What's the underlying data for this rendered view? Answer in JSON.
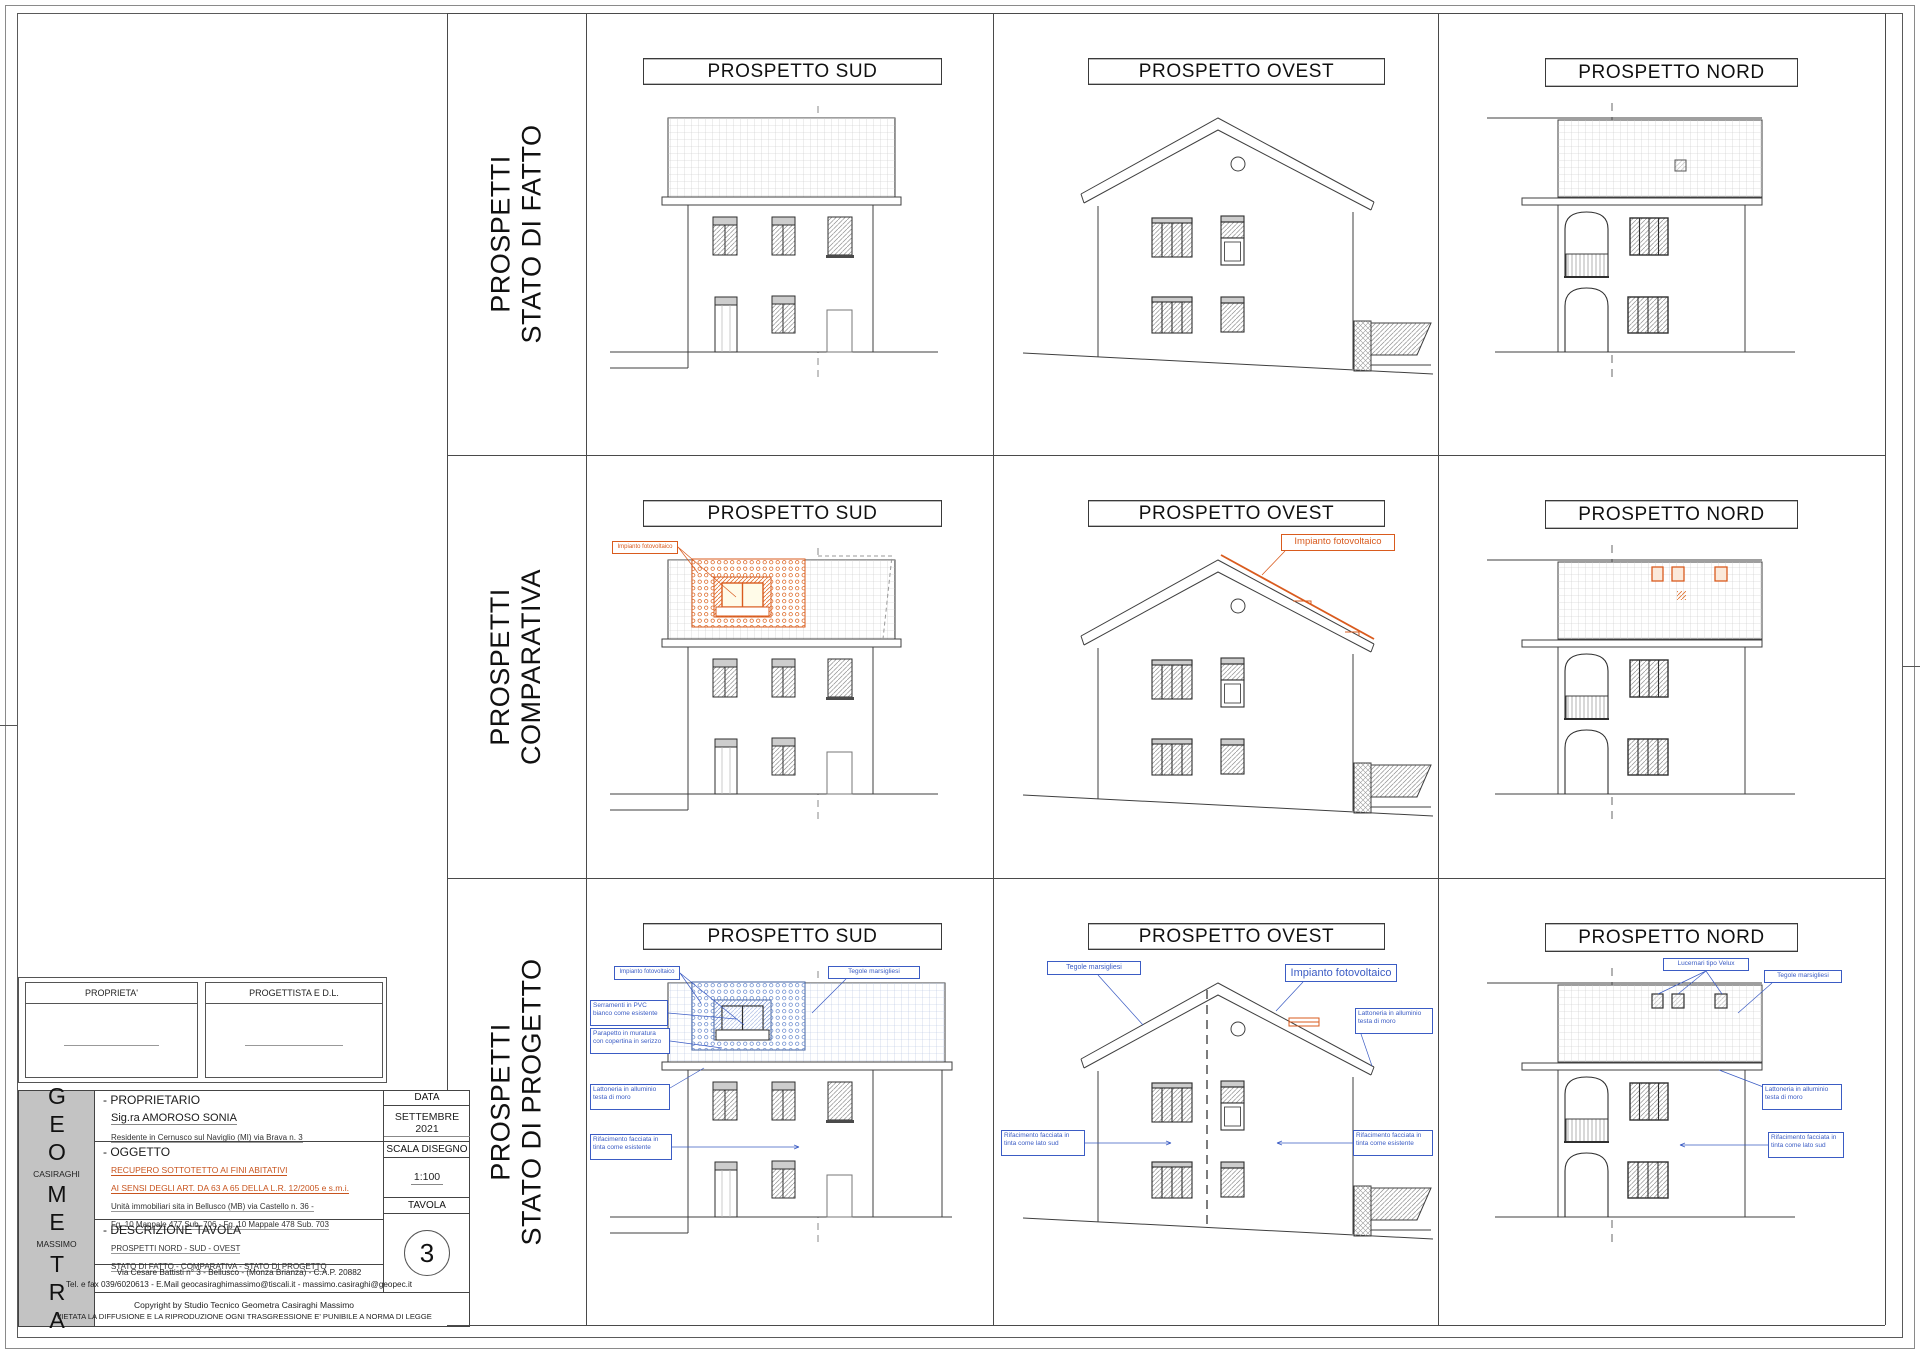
{
  "sheet": {
    "rows": [
      {
        "line1": "PROSPETTI",
        "line2": "STATO DI FATTO"
      },
      {
        "line1": "PROSPETTI",
        "line2": "COMPARATIVA"
      },
      {
        "line1": "PROSPETTI",
        "line2": "STATO DI PROGETTO"
      }
    ],
    "elevation_titles": {
      "sud": "PROSPETTO SUD",
      "ovest": "PROSPETTO OVEST",
      "nord": "PROSPETTO NORD"
    }
  },
  "annotations": {
    "impianto_fotovoltaico": "Impianto fotovoltaico",
    "tegole_marsigliesi": "Tegole marsigliesi",
    "serramenti": "Serramenti in PVC bianco come esistente",
    "parapetto": "Parapetto in muratura con copertina in serizzo",
    "lattoneria": "Lattoneria in alluminio testa di moro",
    "rifacimento_esistente": "Rifacimento facciata in tinta come esistente",
    "rifacimento_lato_sud": "Rifacimento facciata in tinta come lato sud",
    "lucernari": "Lucernari tipo Velux"
  },
  "signature_boxes": {
    "left": "PROPRIETA'",
    "right": "PROGETTISTA  E  D.L."
  },
  "titleblock": {
    "studio": {
      "g1": "GEO",
      "name1": "CASIRAGHI",
      "g2": "ME",
      "name2": "MASSIMO",
      "g3": "TRA"
    },
    "proprietario_header": "- PROPRIETARIO",
    "proprietario_name": "Sig.ra AMOROSO SONIA",
    "proprietario_residenza": "Residente in Cernusco sul Naviglio (MI) via Brava n. 3",
    "oggetto_header": "- OGGETTO",
    "oggetto_line1": "RECUPERO SOTTOTETTO AI FINI ABITATIVI",
    "oggetto_line2": "AI SENSI DEGLI ART. DA 63 A 65 DELLA L.R. 12/2005 e s.m.i.",
    "oggetto_line3": "Unità immobiliari sita in Bellusco (MB) via Castello n. 36  -",
    "oggetto_line4": "Fg. 10  Mappale 477  Sub. 706 - Fg. 10 Mappale 478 Sub. 703",
    "descrizione_header": "- DESCRIZIONE TAVOLA",
    "descrizione_line1": "PROSPETTI NORD - SUD - OVEST",
    "descrizione_line2": "STATO DI FATTO - COMPARATIVA - STATO DI PROGETTO",
    "studio_address": "Via Cesare Battisti n° 3   -   Bellusco   - (Monza Brianza) -   C.A.P. 20882",
    "studio_contacts": "Tel. e fax 039/6020613 - E.Mail geocasiraghimassimo@tiscali.it - massimo.casiraghi@geopec.it",
    "copyright_line1": "Copyright by Studio Tecnico Geometra Casiraghi Massimo",
    "copyright_line2": "VIETATA LA DIFFUSIONE E LA RIPRODUZIONE OGNI TRASGRESSIONE E' PUNIBILE A NORMA DI LEGGE",
    "data_label": "DATA",
    "data_value": "SETTEMBRE 2021",
    "scala_label": "SCALA DISEGNO",
    "scala_value": "1:100",
    "tavola_label": "TAVOLA",
    "tavola_value": "3"
  },
  "colors": {
    "annotation_blue": "#3b5cc4",
    "markup_orange": "#d95b1e"
  }
}
